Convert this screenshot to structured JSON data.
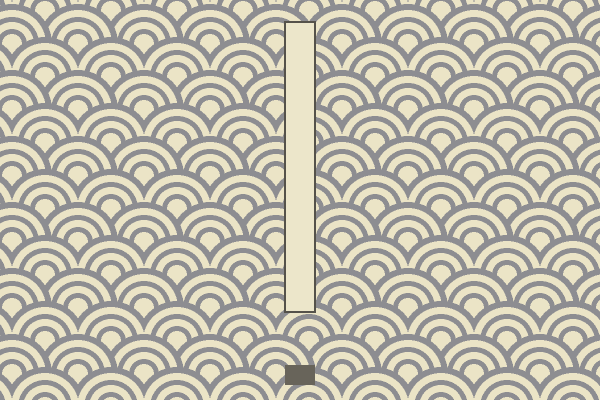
{
  "scene": {
    "background": {
      "pattern": "seigaiha-wave-pattern",
      "base_color": "#ebe4c6",
      "arc_color": "#8d8d91",
      "tile_width": 66,
      "tile_height": 66,
      "row_spacing": 33,
      "circle_radius": 40,
      "ring_stops_px": [
        10,
        15,
        22,
        27,
        34,
        40
      ],
      "pattern_offset_x": 12,
      "pattern_offset_y": 44
    },
    "objects": {
      "pillar": {
        "x": 284,
        "y": 21,
        "width": 32,
        "height": 292,
        "fill": "#ece6ca",
        "border_color": "#55524a",
        "border_px": 2
      },
      "block": {
        "x": 285,
        "y": 365,
        "width": 30,
        "height": 20,
        "fill": "#68645a"
      }
    }
  }
}
